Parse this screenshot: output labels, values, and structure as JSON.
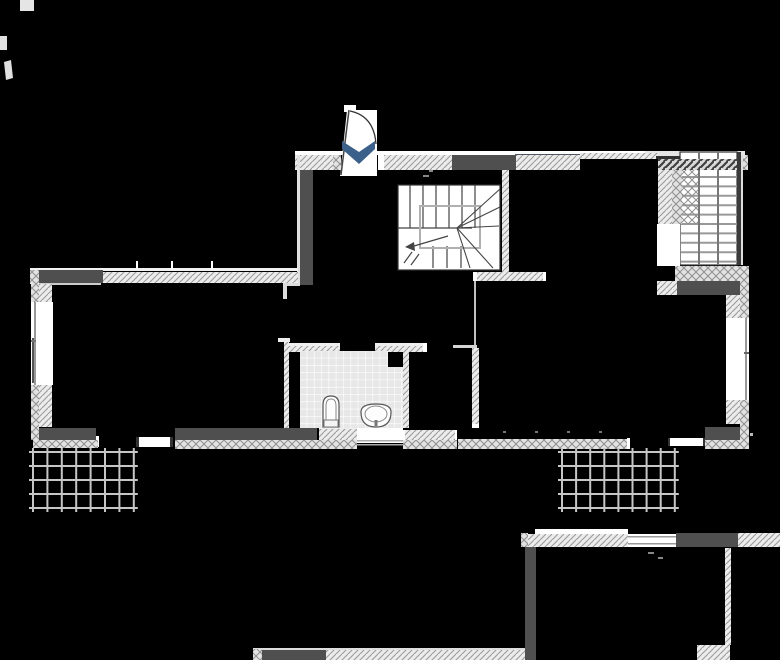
{
  "canvas": {
    "width": 780,
    "height": 660,
    "background": "#000000"
  },
  "colors": {
    "background": "#000000",
    "wall_dark": "#4f4f4f",
    "wall_hatch_bg": "#ececec",
    "wall_hatch_line": "#9b9b9b",
    "crosshatch_bg": "#e2e2e2",
    "crosshatch_line": "#8f8f8f",
    "stripe_bg": "#d9d9d9",
    "stripe_line": "#3f3f3f",
    "tile_bg": "#e7e7e7",
    "tile_line": "#ffffff",
    "grid_line": "#c6c6c6",
    "line_dark": "#333333",
    "arrow_blue": "#3b608a",
    "fixture_stroke": "#555555"
  },
  "icons": {
    "door_swing_arrow": "chevron-down"
  },
  "balcony_grids": [
    {
      "name": "left",
      "x": 33,
      "y": 452,
      "cols": 7,
      "rows": 4,
      "cw": 14.4,
      "rh": 14,
      "overhang": 4
    },
    {
      "name": "right",
      "x": 562,
      "y": 452,
      "cols": 8,
      "rows": 4,
      "cw": 14.1,
      "rh": 14,
      "overhang": 4
    }
  ],
  "ladder": {
    "x1": 681,
    "x2": 737,
    "y0": 177,
    "step": 9.4,
    "count": 10,
    "rails": [
      699,
      718
    ]
  },
  "stairs": {
    "upper_risers": {
      "x_start": 410,
      "step": 13,
      "count": 6,
      "y1": 185,
      "y2": 228
    },
    "lower_risers": {
      "xs": [
        433,
        447,
        461
      ],
      "y1": 246,
      "y2": 268
    },
    "fan_hub": [
      457,
      228
    ],
    "fan_targets": [
      [
        500,
        189
      ],
      [
        500,
        207
      ],
      [
        499,
        226
      ],
      [
        493,
        268
      ],
      [
        470,
        268
      ]
    ]
  }
}
